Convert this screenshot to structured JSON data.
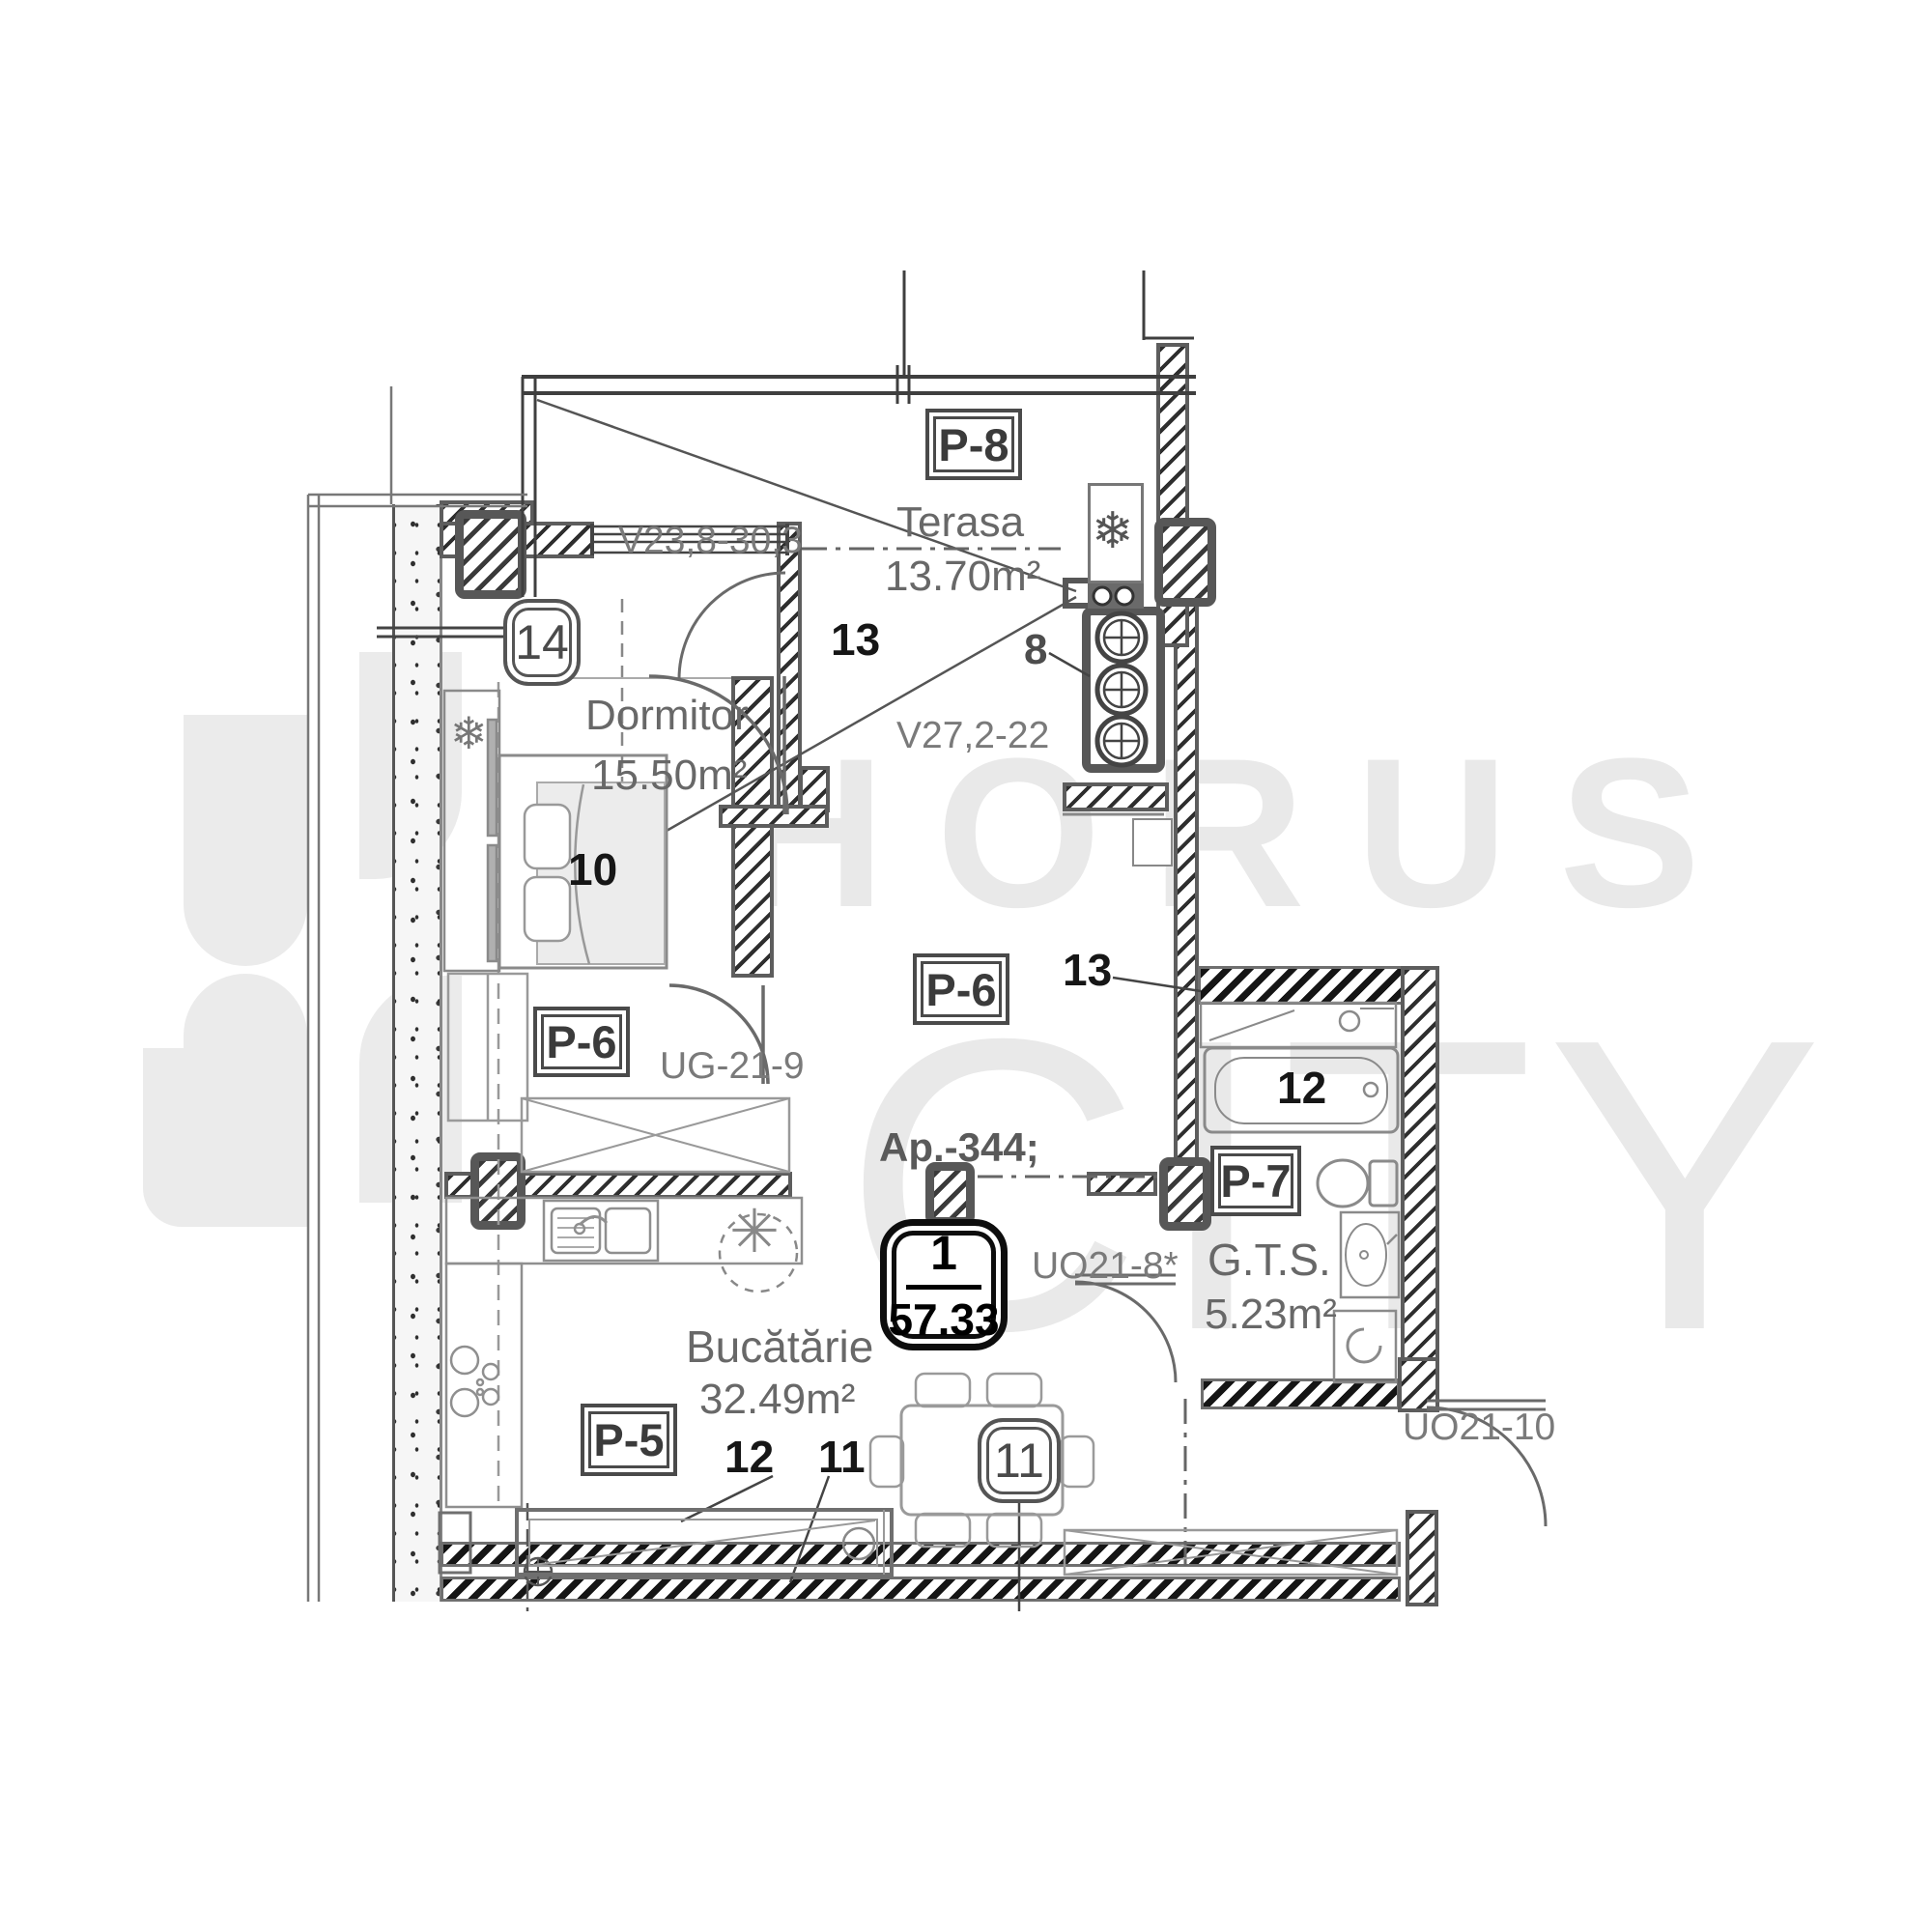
{
  "watermark": {
    "brand_top": "HORUS",
    "brand_bottom": "CITY"
  },
  "apartment_badge": {
    "unit_number": "1",
    "total_area": "57.33"
  },
  "apartment_label": "Ap.-344;",
  "rooms": {
    "terasa": {
      "name": "Terasa",
      "area": "13.70m²",
      "zone": "13"
    },
    "dormitor": {
      "name": "Dormitor",
      "area": "15.50m²"
    },
    "bucatarie": {
      "name": "Bucătărie",
      "area": "32.49m²"
    },
    "gts": {
      "name": "G.T.S.",
      "area": "5.23m²"
    },
    "hall_zone": "13"
  },
  "door_labels": {
    "p8": "P-8",
    "p6_bedroom": "P-6",
    "p6_living": "P-6",
    "p7": "P-7",
    "p5": "P-5"
  },
  "opening_codes": {
    "window_terrace": "V23,8-30,3",
    "window_inner": "V27,2-22",
    "sliding_door": "UG-21-9",
    "door_bath": "UO21-8*",
    "door_entry": "UO21-10"
  },
  "item_numbers": {
    "bed": "10",
    "table_badge": "11",
    "kitchen_a": "12",
    "kitchen_b": "11",
    "bathtub": "12",
    "riser": "8",
    "wardrobe_badge": "14"
  },
  "icons": {
    "snowflake": "❄",
    "boiler_star": "✳"
  }
}
